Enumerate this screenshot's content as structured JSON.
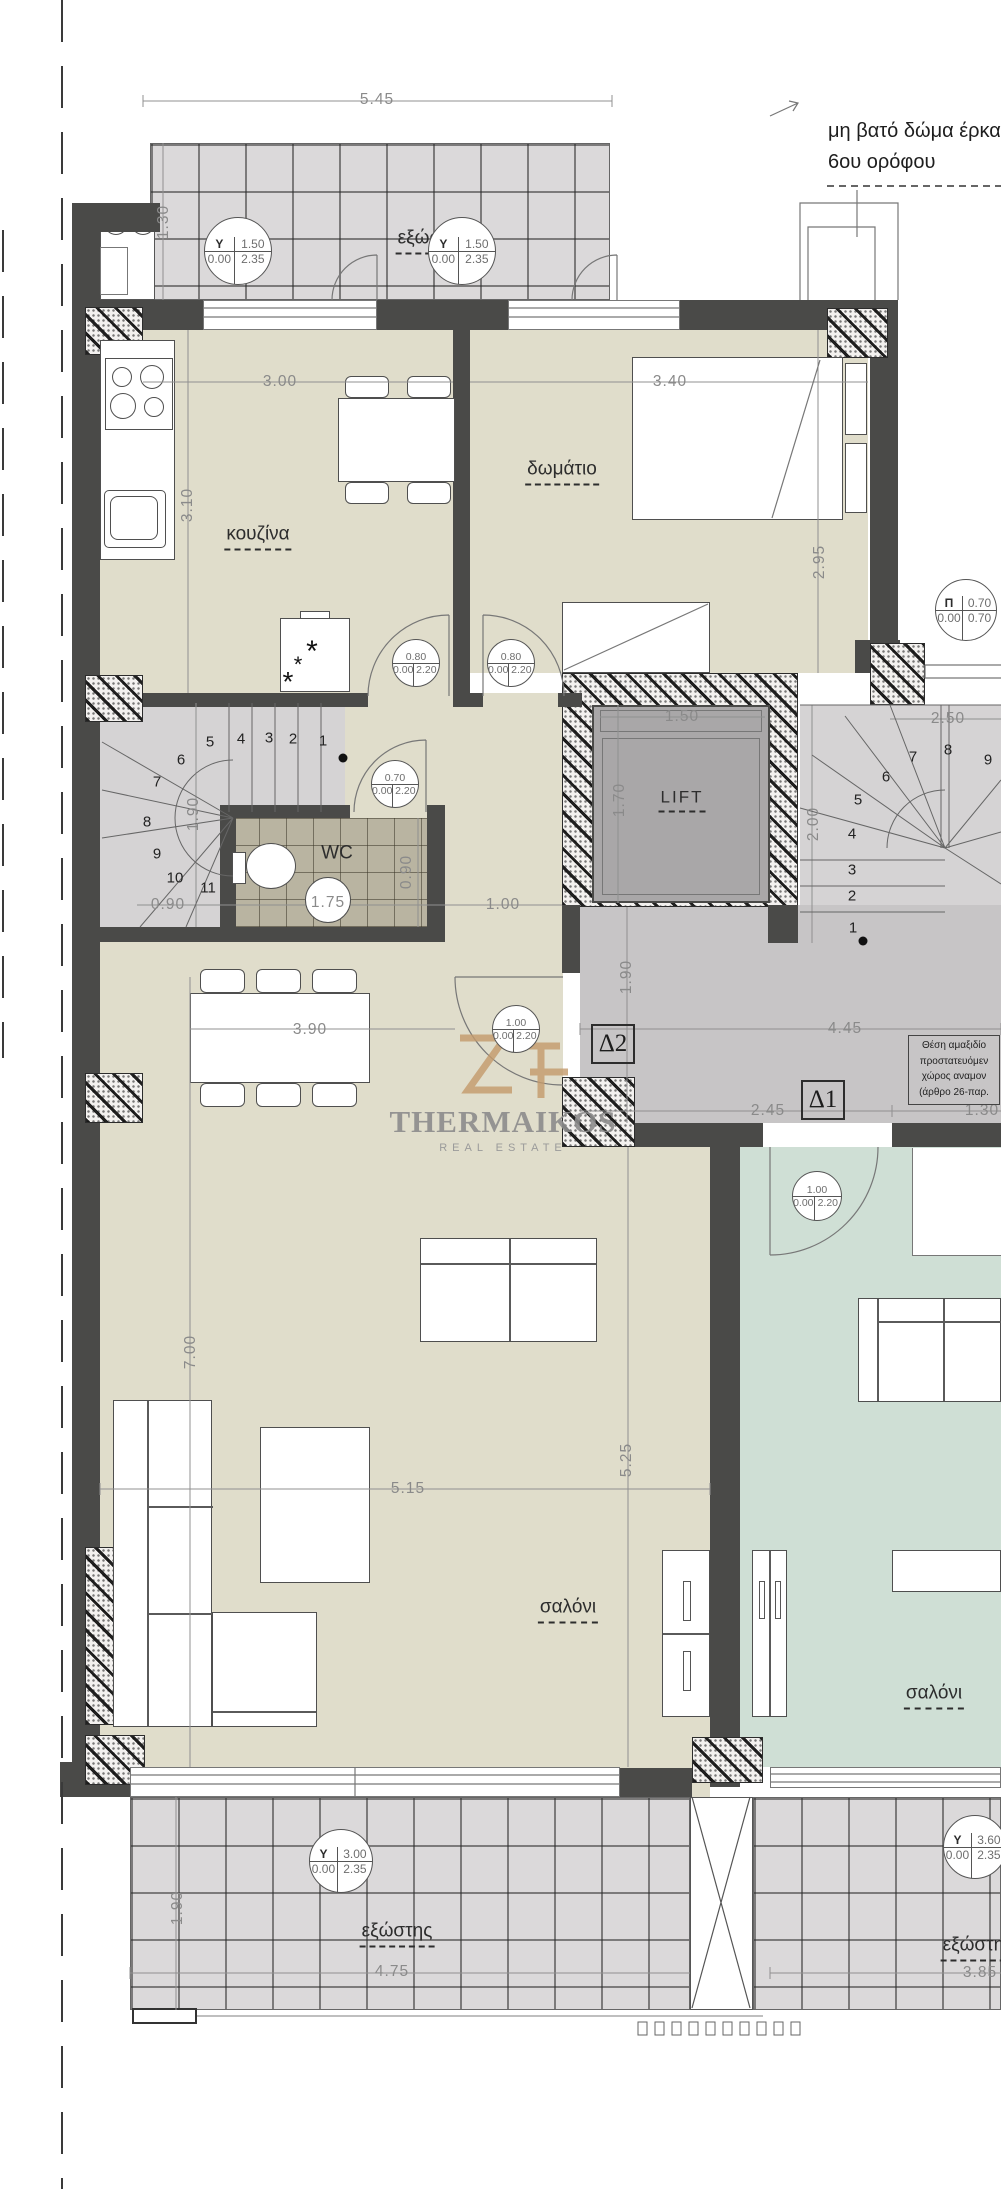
{
  "colors": {
    "wall": "#4a4a48",
    "floor_left_apartment": "#e0ddcb",
    "floor_right_apartment": "#cfdfd5",
    "balcony_tile": "#dbd9da",
    "stair_gray": "#d5d3d4",
    "landing_gray": "#c7c5c6",
    "wc_tile": "#b9b4a1",
    "lift_cab": "#a9a7a8",
    "watermark_tan": "#c49a6c",
    "dim_text": "#8a8a8a"
  },
  "annotations": {
    "roof_note_line1": "μη βατό δώμα έρκα",
    "roof_note_line2": "6ου ορόφου"
  },
  "watermark": {
    "brand": "THERMAIKOS",
    "tagline": "REAL ESTATE"
  },
  "info_box": {
    "lines": [
      "Θέση αμαξιδίο",
      "προστατευόμεν",
      "χώρος αναμον",
      "(άρθρο 26-παρ."
    ]
  },
  "room_labels": [
    {
      "id": "balcony-top",
      "text": "εξώστης",
      "x": 433,
      "y": 241
    },
    {
      "id": "kitchen",
      "text": "κουζίνα",
      "x": 258,
      "y": 537
    },
    {
      "id": "bedroom",
      "text": "δωμάτιο",
      "x": 562,
      "y": 472
    },
    {
      "id": "wc",
      "text": "WC",
      "x": 337,
      "y": 855,
      "plain": true
    },
    {
      "id": "lift",
      "text": "LIFT",
      "x": 682,
      "y": 800,
      "size": 17,
      "cls": "lift-label"
    },
    {
      "id": "living-left",
      "text": "σαλόνι",
      "x": 568,
      "y": 1610
    },
    {
      "id": "living-right",
      "text": "σαλόνι",
      "x": 934,
      "y": 1696
    },
    {
      "id": "balcony-bottom-left",
      "text": "εξώστης",
      "x": 397,
      "y": 1934
    },
    {
      "id": "balcony-bottom-right",
      "text": "εξώστης",
      "x": 978,
      "y": 1948
    }
  ],
  "dimensions": [
    {
      "text": "5.45",
      "x": 377,
      "y": 100
    },
    {
      "text": "1.30",
      "x": 164,
      "y": 222,
      "rot": true
    },
    {
      "text": "3.00",
      "x": 280,
      "y": 382
    },
    {
      "text": "3.10",
      "x": 188,
      "y": 505,
      "rot": true
    },
    {
      "text": "3.40",
      "x": 670,
      "y": 382
    },
    {
      "text": "2.95",
      "x": 820,
      "y": 562,
      "rot": true
    },
    {
      "text": "1.50",
      "x": 682,
      "y": 717
    },
    {
      "text": "1.70",
      "x": 620,
      "y": 800,
      "rot": true
    },
    {
      "text": "2.50",
      "x": 948,
      "y": 719
    },
    {
      "text": "2.00",
      "x": 814,
      "y": 824,
      "rot": true
    },
    {
      "text": "1.90",
      "x": 194,
      "y": 814,
      "rot": true
    },
    {
      "text": "0.90",
      "x": 168,
      "y": 905
    },
    {
      "text": "1.75",
      "x": 328,
      "y": 903
    },
    {
      "text": "0.90",
      "x": 407,
      "y": 872,
      "rot": true
    },
    {
      "text": "1.00",
      "x": 503,
      "y": 905
    },
    {
      "text": "3.90",
      "x": 310,
      "y": 1030
    },
    {
      "text": "1.90",
      "x": 627,
      "y": 977,
      "rot": true
    },
    {
      "text": "4.45",
      "x": 845,
      "y": 1029
    },
    {
      "text": "2.45",
      "x": 768,
      "y": 1111
    },
    {
      "text": "1.30",
      "x": 982,
      "y": 1111
    },
    {
      "text": "7.00",
      "x": 191,
      "y": 1352,
      "rot": true
    },
    {
      "text": "5.15",
      "x": 408,
      "y": 1489
    },
    {
      "text": "5.25",
      "x": 627,
      "y": 1460,
      "rot": true
    },
    {
      "text": "1.90",
      "x": 178,
      "y": 1908,
      "rot": true
    },
    {
      "text": "4.75",
      "x": 392,
      "y": 1972
    },
    {
      "text": "3.85",
      "x": 980,
      "y": 1973
    }
  ],
  "door_markers": [
    {
      "tl": "Y",
      "tr": "1.50",
      "bl": "0.00",
      "br": "2.35",
      "x": 238,
      "y": 251,
      "r": 34
    },
    {
      "tl": "Y",
      "tr": "1.50",
      "bl": "0.00",
      "br": "2.35",
      "x": 462,
      "y": 251,
      "r": 34
    },
    {
      "tl": "Π",
      "tr": "0.70",
      "bl": "0.00",
      "br": "0.70",
      "x": 966,
      "y": 610,
      "r": 31
    },
    {
      "tr": "0.80",
      "bl": "0.00",
      "br": "2.20",
      "x": 416,
      "y": 663,
      "r": 24
    },
    {
      "tr": "0.80",
      "bl": "0.00",
      "br": "2.20",
      "x": 511,
      "y": 663,
      "r": 24
    },
    {
      "tr": "0.70",
      "bl": "0.00",
      "br": "2.20",
      "x": 395,
      "y": 784,
      "r": 24
    },
    {
      "tr": "1.00",
      "bl": "0.00",
      "br": "2.20",
      "x": 516,
      "y": 1029,
      "r": 24
    },
    {
      "tr": "1.00",
      "bl": "0.00",
      "br": "2.20",
      "x": 817,
      "y": 1196,
      "r": 25
    },
    {
      "tl": "Y",
      "tr": "3.00",
      "bl": "0.00",
      "br": "2.35",
      "x": 341,
      "y": 1861,
      "r": 32
    },
    {
      "tl": "Y",
      "tr": "3.60",
      "bl": "0.00",
      "br": "2.35",
      "x": 975,
      "y": 1847,
      "r": 32
    }
  ],
  "stairs": {
    "left": [
      {
        "n": "1",
        "x": 323,
        "y": 741
      },
      {
        "n": "2",
        "x": 293,
        "y": 739
      },
      {
        "n": "3",
        "x": 269,
        "y": 738
      },
      {
        "n": "4",
        "x": 241,
        "y": 739
      },
      {
        "n": "5",
        "x": 210,
        "y": 742
      },
      {
        "n": "6",
        "x": 181,
        "y": 760
      },
      {
        "n": "7",
        "x": 157,
        "y": 782
      },
      {
        "n": "8",
        "x": 147,
        "y": 822
      },
      {
        "n": "9",
        "x": 157,
        "y": 854
      },
      {
        "n": "10",
        "x": 175,
        "y": 878
      },
      {
        "n": "11",
        "x": 208,
        "y": 888
      }
    ],
    "right": [
      {
        "n": "1",
        "x": 853,
        "y": 928
      },
      {
        "n": "2",
        "x": 852,
        "y": 896
      },
      {
        "n": "3",
        "x": 852,
        "y": 870
      },
      {
        "n": "4",
        "x": 852,
        "y": 834
      },
      {
        "n": "5",
        "x": 858,
        "y": 800
      },
      {
        "n": "6",
        "x": 886,
        "y": 777
      },
      {
        "n": "7",
        "x": 913,
        "y": 757
      },
      {
        "n": "8",
        "x": 948,
        "y": 750
      },
      {
        "n": "9",
        "x": 988,
        "y": 760
      }
    ]
  },
  "delta_markers": [
    {
      "text": "Δ2",
      "x": 613,
      "y": 1044
    },
    {
      "text": "Δ1",
      "x": 823,
      "y": 1100
    }
  ],
  "decor_glyphs": [
    {
      "g": "*",
      "x": 312,
      "y": 652,
      "s": 30
    },
    {
      "g": "*",
      "x": 298,
      "y": 665,
      "s": 22
    },
    {
      "g": "*",
      "x": 288,
      "y": 682,
      "s": 28
    }
  ]
}
